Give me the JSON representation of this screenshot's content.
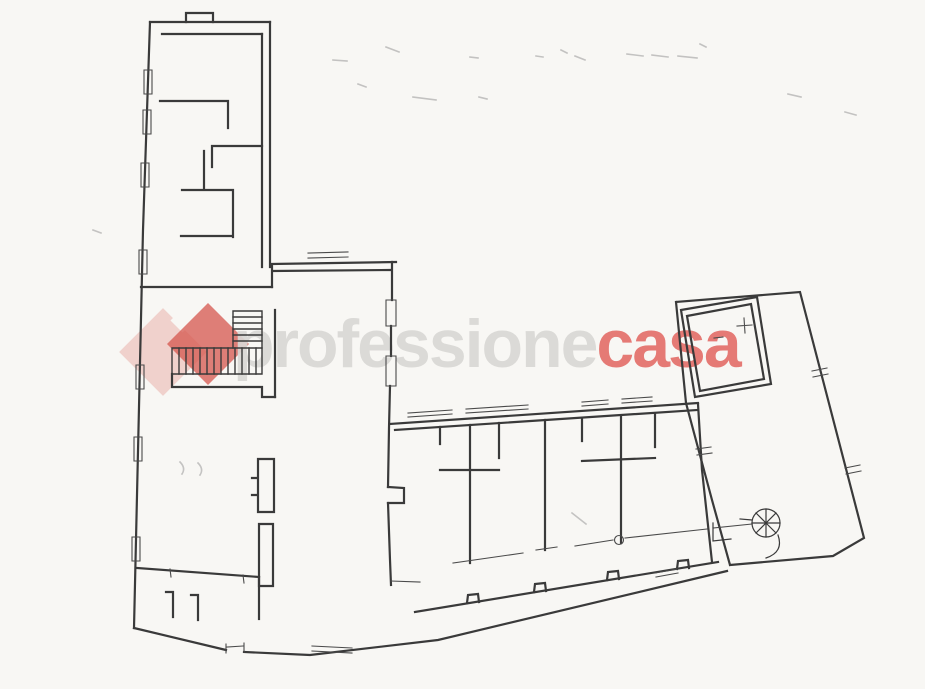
{
  "page": {
    "background": "#f8f7f4",
    "width": 925,
    "height": 689
  },
  "watermark": {
    "text_left": "professione",
    "text_right": "casa",
    "text_left_color": "#d9d8d5",
    "text_right_color": "#e4706b",
    "logo_light_color": "#e7aca4",
    "logo_dark_color": "#d5564d",
    "logo_light_opacity": 0.5,
    "logo_dark_opacity": 0.75
  },
  "floorplan": {
    "stroke_color": "#3a3a3a",
    "layers": [
      {
        "name": "walls",
        "stroke": "#3a3a3a",
        "width": 2.2,
        "opacity": 1,
        "paths": [
          "M186,13 L213,13 M186,14 L186,22 M213,14 L213,22",
          "M150,22 L270,22",
          "M150,22 L143,230 L134,628",
          "M270,22 L270,267",
          "M262,34 L262,267",
          "M162,34 L262,34",
          "M160,101 L228,101 M228,101 L228,128",
          "M212,146 L262,146 M212,146 L212,167",
          "M182,190 L233,190 M204,151 L204,190 M233,190 L233,237 M181,236 L233,236",
          "M141,287 L272,287",
          "M272,264 L396,262 M272,271 L390,270 M272,264 L272,287",
          "M392,262 L392,300 M391,326 L391,356",
          "M390,386 L389,428 L388,487 M388,503 L390,560 L391,585",
          "M388,487 L404,488 L404,503 L388,503",
          "M134,628 L226,650 M244,652 L310,655 L438,640 L727,571",
          "M415,612 L718,562",
          "M467,603 L468,595 L478,594 L479,602 M534,592 L535,584 L545,583 L546,591 M607,580 L608,572 L618,571 L619,579 M677,569 L678,561 L688,560 L689,568",
          "M137,568 L259,577",
          "M173,592 L173,617 M166,592 L173,592 M198,595 L198,620 M191,595 L198,595",
          "M259,577 L259,619",
          "M258,459 L274,459 L274,512 L258,512 Z M252,478 L258,478 M252,495 L258,495",
          "M259,524 L273,524 L273,586 L259,586 Z",
          "M275,310 L275,397",
          "M172,374 L172,387 L262,387 L262,397 L275,397",
          "M390,424 L698,403 M395,430 L697,410",
          "M440,427 L440,444 M470,425 L470,563 M499,423 L499,458 M545,420 L545,550 M582,418 L582,441 M621,416 L621,543 M655,414 L655,447",
          "M440,470 L499,470 M582,461 L655,458",
          "M698,404 L702,470 L712,562",
          "M676,302 L800,292 L864,538 L833,556 L730,565 M676,302 L686,403 L712,500 L730,565",
          "M681,310 L757,297 L771,384 L695,397 Z",
          "M687,316 L751,304 L764,379 L700,391 Z"
        ]
      },
      {
        "name": "staircase",
        "stroke": "#3a3a3a",
        "width": 1.4,
        "opacity": 1,
        "paths": [
          "M233,311 L262,311 M233,311 L233,348 M262,311 L262,348",
          "M233,317 L262,317 M233,323 L262,323 M233,329 L262,329 M233,335 L262,335 M233,341 L262,341",
          "M172,348 L262,348 M172,348 L172,374 M172,374 L262,374 M262,348 L262,374",
          "M179,348 L179,374 M186,348 L186,374 M193,348 L193,374 M200,348 L200,374 M207,348 L207,374 M214,348 L214,374 M221,348 L221,374 M228,348 L228,374 M235,348 L235,374 M242,348 L242,374 M249,348 L249,374 M256,348 L256,374"
        ]
      },
      {
        "name": "thin-details",
        "stroke": "#4a4a4a",
        "width": 1.1,
        "opacity": 1,
        "paths": [
          "M144,70 h8 v24 h-8 z M143,110 h8 v24 h-8 z M141,163 h8 v24 h-8 z M139,250 h8 v24 h-8 z M136,365 h8 v24 h-8 z M134,437 h8 v24 h-8 z M132,537 h8 v24 h-8 z",
          "M386,300 h10 v26 h-10 z M386,356 h10 v30 h-10 z",
          "M655,573 L677,569 M656,577 L678,573 M226,644 L226,653 M244,643 L244,652 M227,647 L243,646 M312,646 L352,648 M312,651 L352,653",
          "M308,258 L348,257 M308,253 L348,252",
          "M408,417 L452,414 M408,413 L452,410 M466,413 L528,409 M466,409 L528,405 M582,406 L608,404 M582,402 L608,400 M622,403 L652,401 M622,399 L652,397",
          "M453,563 L523,553 M536,550 L557,547 M575,546 L613,540 M625,538 L707,529 M713,528 L752,524 M391,581 L420,582",
          "M614.5,540 a4.5,4.5 0 1,0 9,0 a4.5,4.5 0 1,0 -9,0",
          "M696,449 L711,447 M697,455 L712,453",
          "M812,371 L827,368 M813,377 L828,374 M845,468 L860,465 M846,474 L861,471",
          "M737,326 L752,325 M744,318 L745,333 M714,338 L723,337",
          "M170,569 L171,577 M243,575 L244,583"
        ]
      },
      {
        "name": "spiral-staircase",
        "stroke": "#3a3a3a",
        "width": 1.2,
        "opacity": 1,
        "paths": [
          "M752,523 a14,14 0 1,0 28,0 a14,14 0 1,0 -28,0",
          "M766,523 L780,523 M766,523 L776,533 M766,523 L766,537 M766,523 L756,533 M766,523 L752,523 M766,523 L756,513 M766,523 L766,509 M766,523 L776,513",
          "M740,519 L752,520 M713,523 L713,541 L731,539 M778,535 Q784,552 766,558"
        ]
      },
      {
        "name": "scan-smudges",
        "stroke": "#8f8f8f",
        "width": 1.6,
        "opacity": 0.5,
        "paths": [
          "M386,47 L399,52",
          "M333,60 L347,61",
          "M358,84 L366,87",
          "M413,97 L436,100",
          "M470,57 L478,58",
          "M479,97 L487,99",
          "M536,56 L543,57",
          "M561,50 L567,53 M575,56 L585,60",
          "M627,54 L643,56 M652,55 L668,57 M678,56 L697,58",
          "M700,44 L706,47",
          "M788,94 L801,97",
          "M845,112 L856,115",
          "M93,230 L101,233",
          "M180,462 Q186,468 182,474 M198,463 Q204,469 200,475",
          "M572,513 L586,524"
        ]
      }
    ]
  }
}
